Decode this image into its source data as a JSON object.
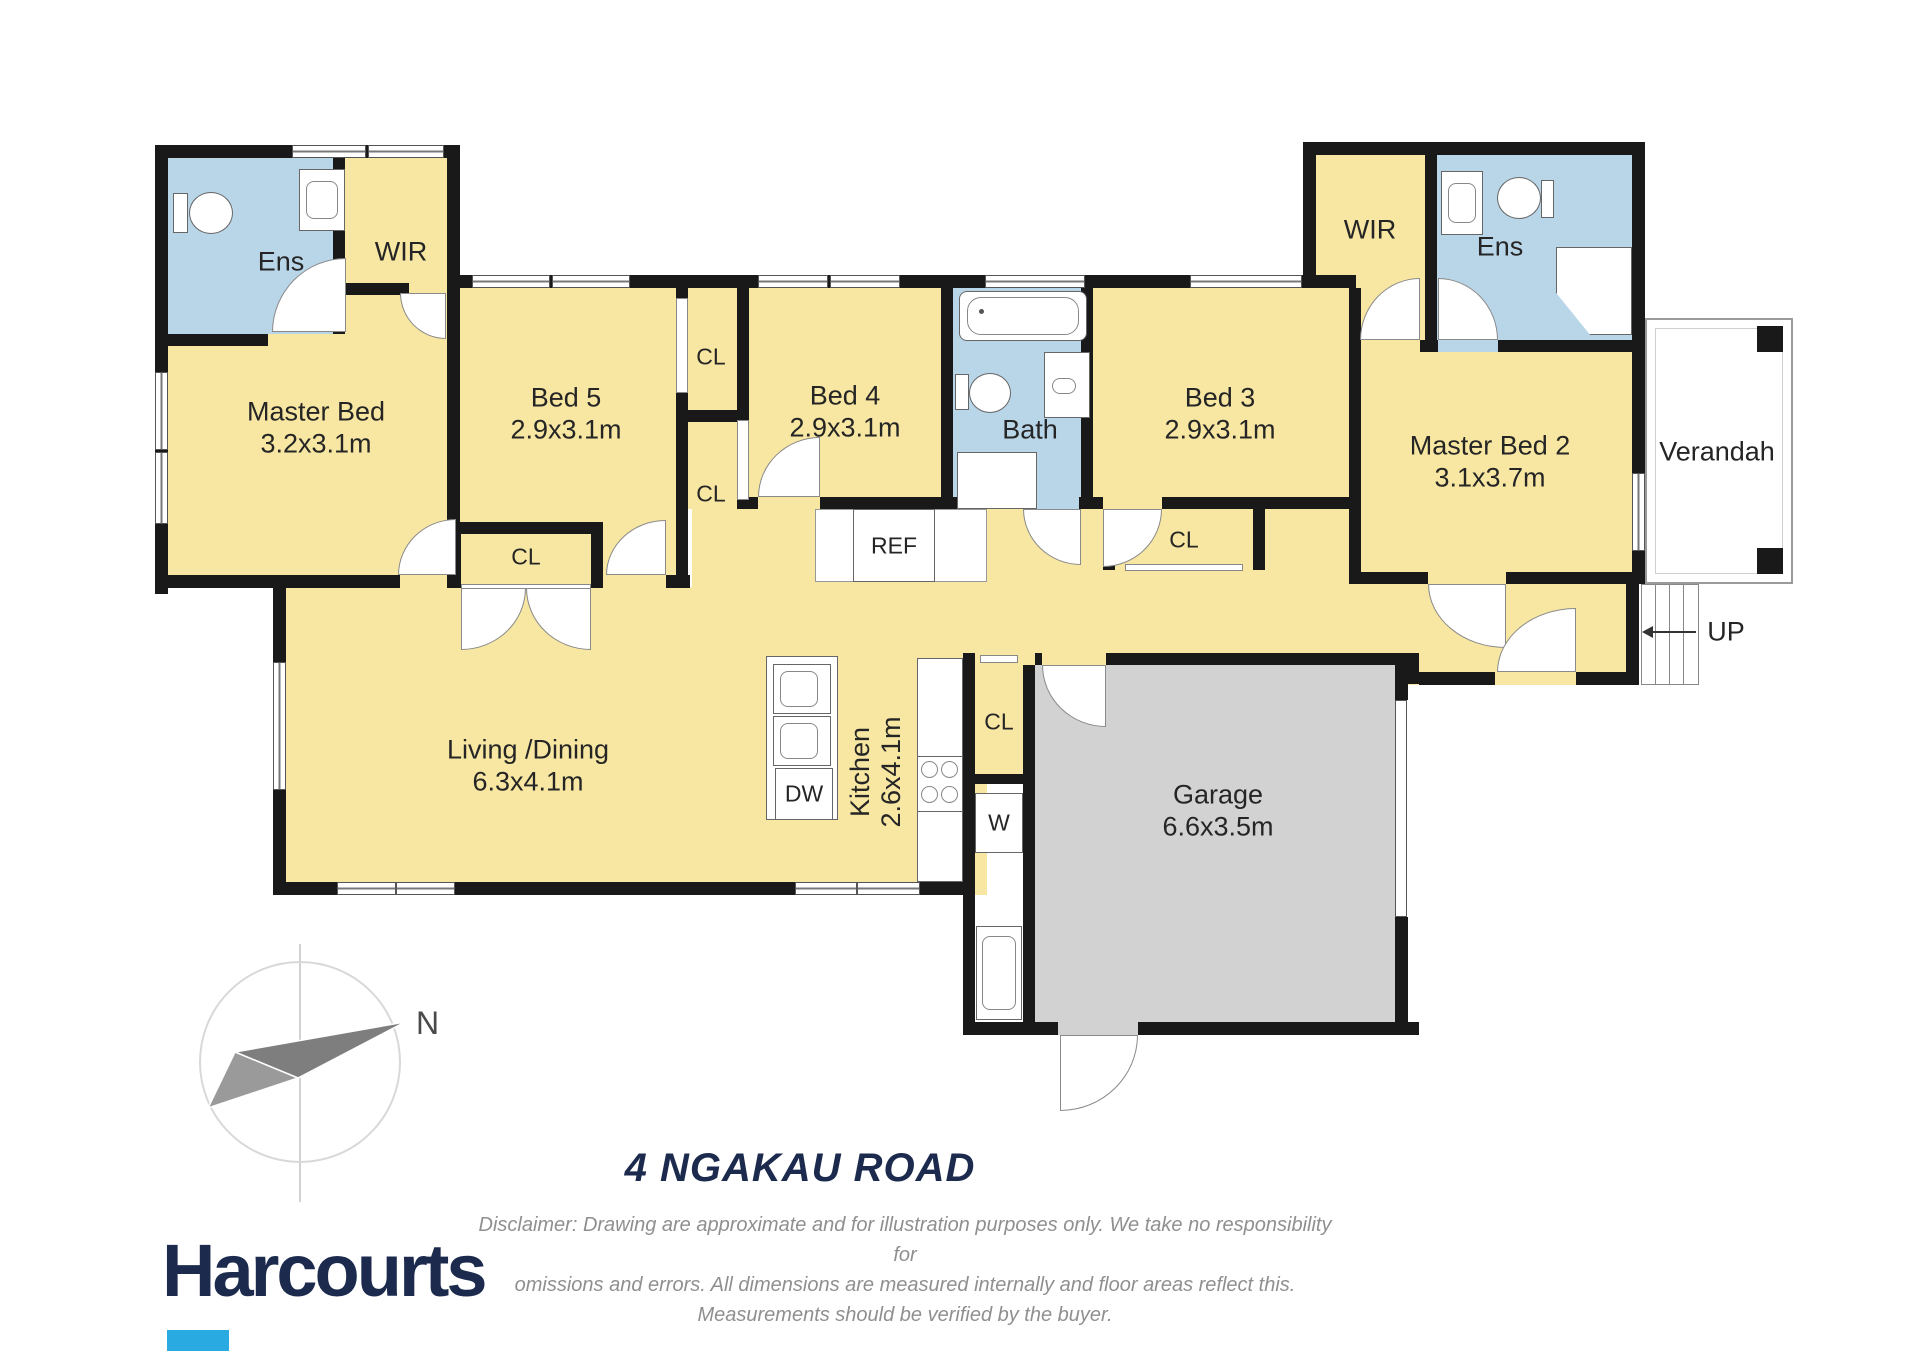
{
  "page": {
    "title": "4 NGAKAU ROAD"
  },
  "brand": {
    "name": "Harcourts",
    "accent_color": "#29abe2",
    "navy_color": "#1b2a4d"
  },
  "disclaimer": {
    "line1": "Disclaimer: Drawing are approximate and for illustration purposes only. We take no responsibility for",
    "line2": "omissions and errors. All dimensions are measured internally and floor areas reflect this.",
    "line3": "Measurements should be verified by the buyer."
  },
  "compass": {
    "north": "N"
  },
  "rooms": {
    "master_bed": {
      "name": "Master Bed",
      "dims": "3.2x3.1m"
    },
    "ens_left": {
      "name": "Ens"
    },
    "wir_left": {
      "name": "WIR"
    },
    "bed5": {
      "name": "Bed 5",
      "dims": "2.9x3.1m"
    },
    "bed4": {
      "name": "Bed 4",
      "dims": "2.9x3.1m"
    },
    "bath": {
      "name": "Bath"
    },
    "bed3": {
      "name": "Bed 3",
      "dims": "2.9x3.1m"
    },
    "wir_right": {
      "name": "WIR"
    },
    "ens_right": {
      "name": "Ens"
    },
    "master_bed2": {
      "name": "Master Bed 2",
      "dims": "3.1x3.7m"
    },
    "living_dining": {
      "name": "Living /Dining",
      "dims": "6.3x4.1m"
    },
    "kitchen": {
      "name": "Kitchen",
      "dims": "2.6x4.1m"
    },
    "garage": {
      "name": "Garage",
      "dims": "6.6x3.5m"
    },
    "verandah": {
      "name": "Verandah"
    }
  },
  "labels": {
    "closet": "CL",
    "fridge": "REF",
    "dishwasher": "DW",
    "washer": "W",
    "stairs_up": "UP"
  },
  "colors": {
    "room_fill": "#f7e7a2",
    "wet_fill": "#b9d6e9",
    "garage_fill": "#d2d2d2",
    "wall": "#191919"
  }
}
